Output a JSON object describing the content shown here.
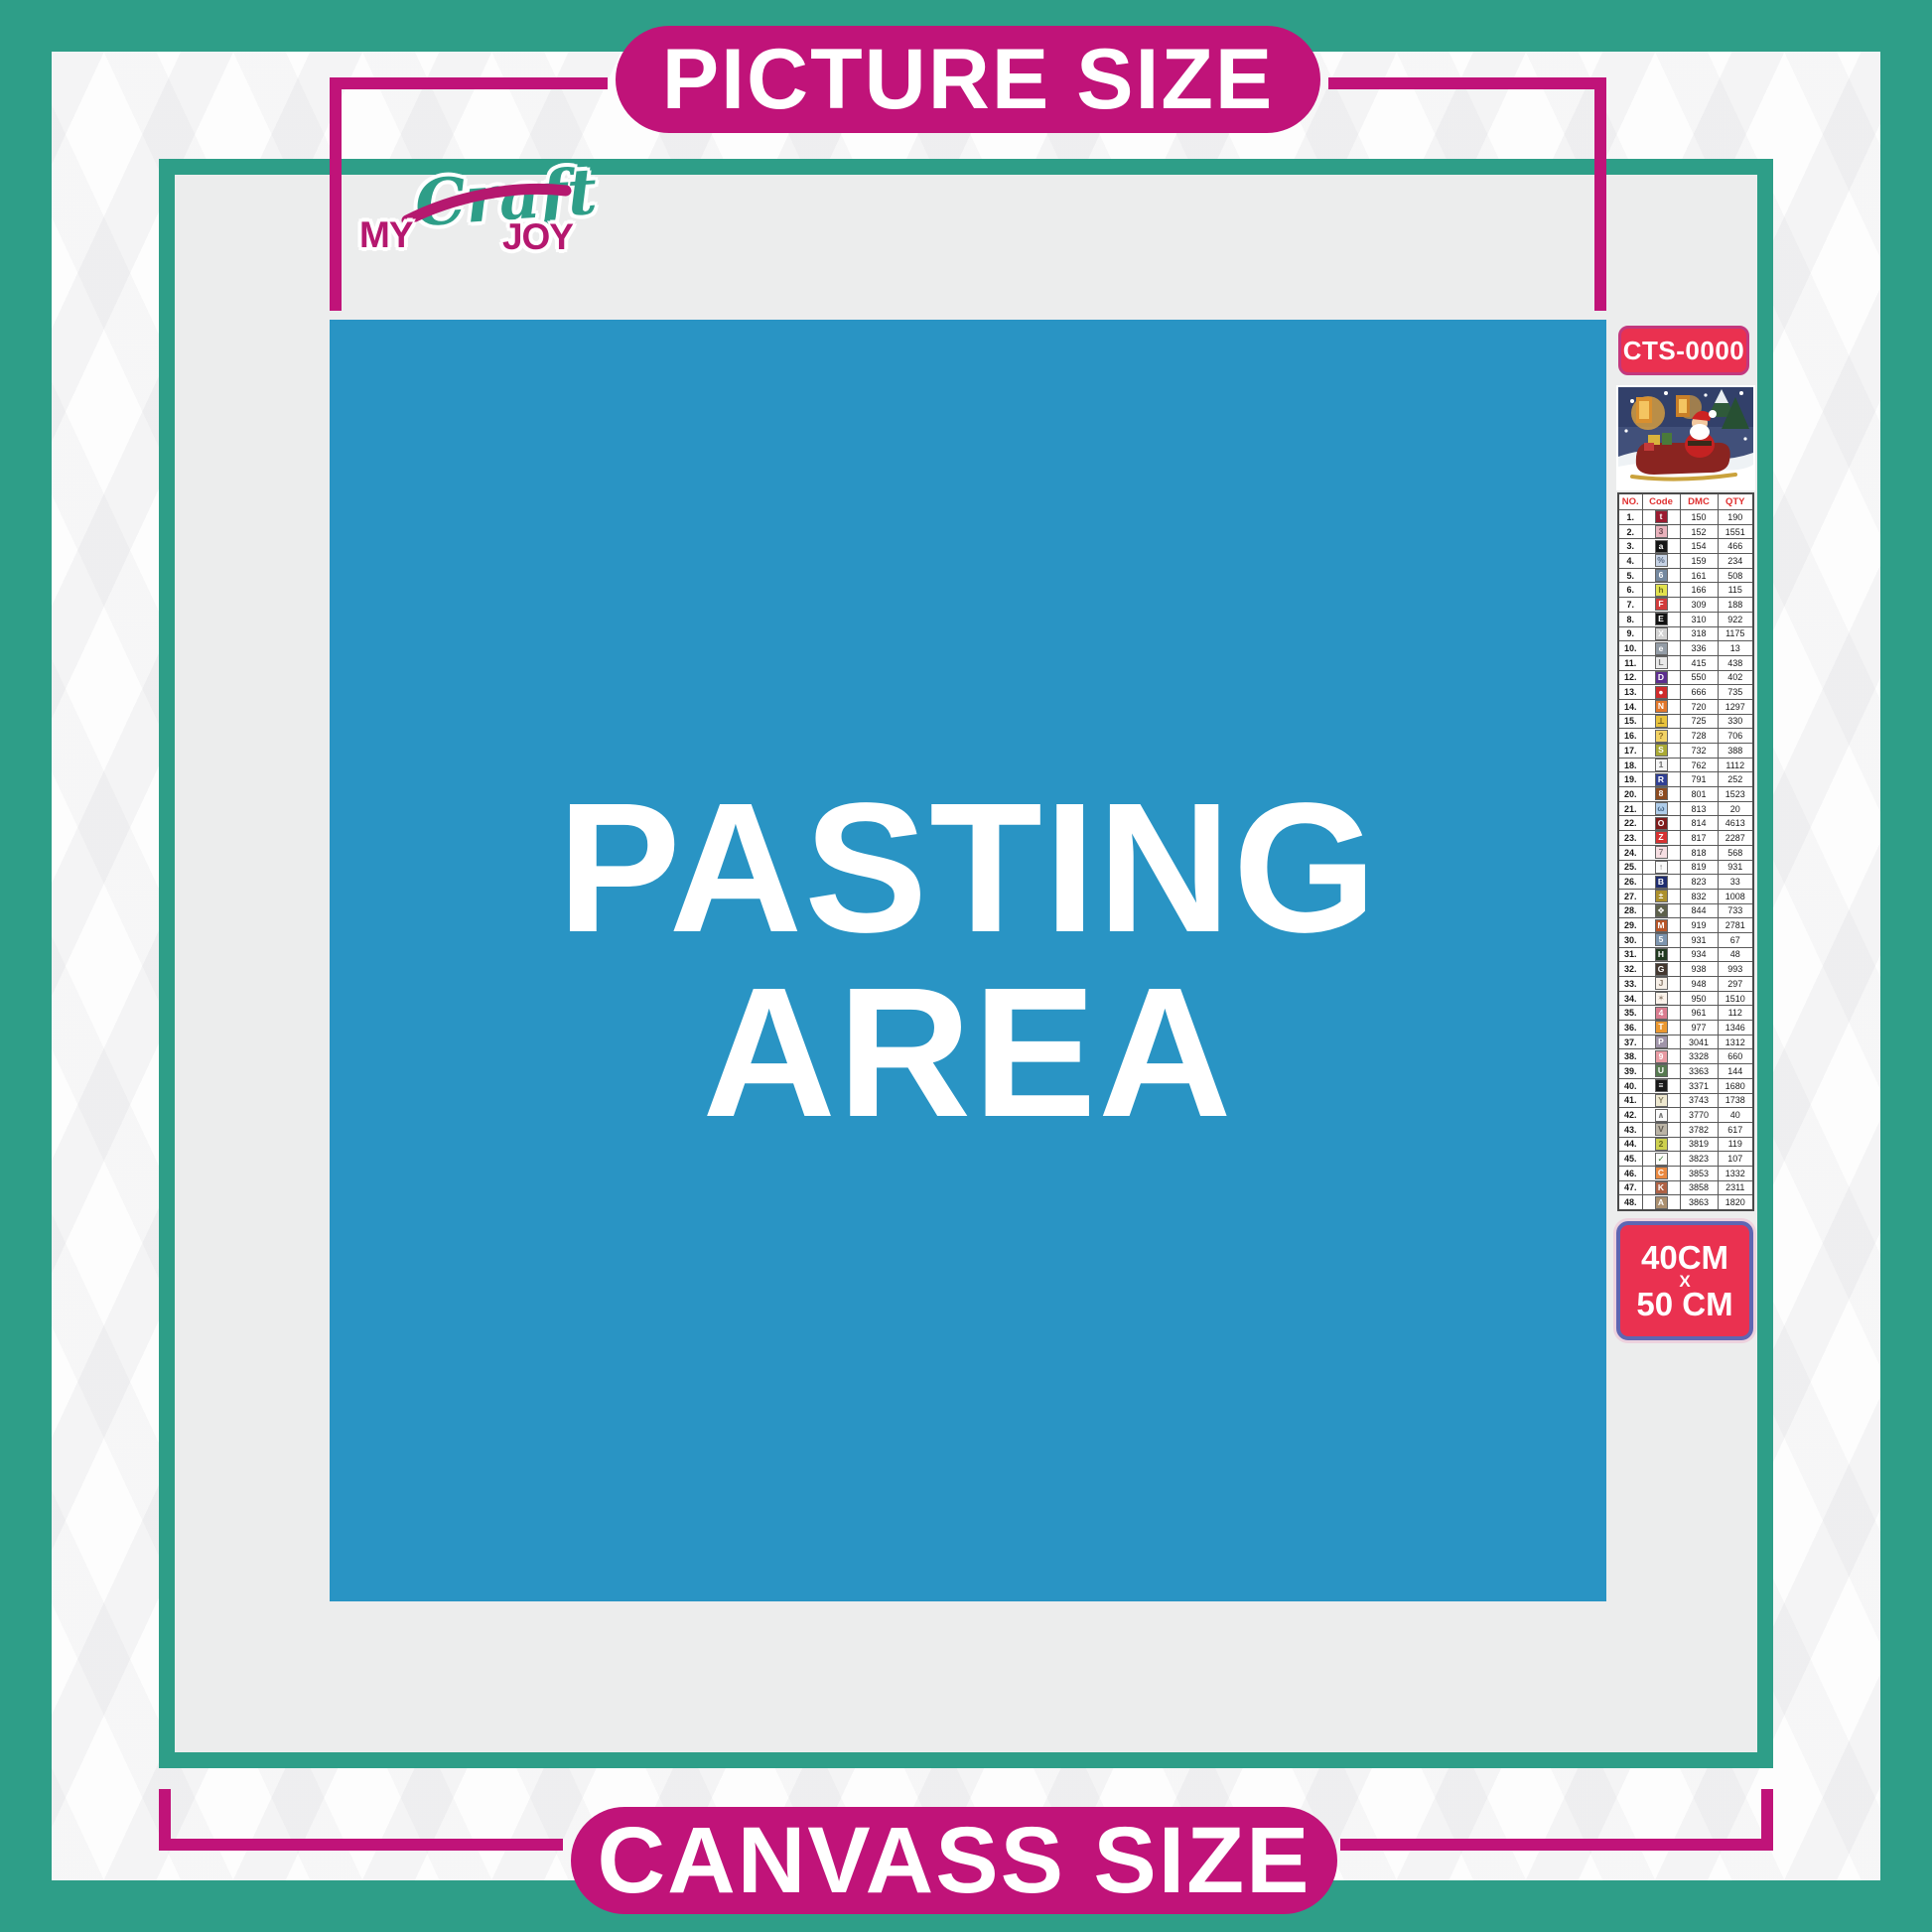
{
  "colors": {
    "teal": "#2E9E88",
    "magenta": "#C01379",
    "badge_red": "#EA3150",
    "pasting_blue": "#2994C4",
    "content_gray": "#ECEDED"
  },
  "banners": {
    "top": "PICTURE SIZE",
    "bottom": "CANVASS SIZE"
  },
  "logo": {
    "my": "MY",
    "craft": "Craft",
    "joy": "JOY"
  },
  "pasting": {
    "line1": "PASTING",
    "line2": "AREA"
  },
  "sidebar": {
    "sku": "CTS-0000",
    "preview": "santa-claus-sleigh-artwork",
    "size": {
      "l1": "40CM",
      "l2": "X",
      "l3": "50 CM"
    },
    "table": {
      "headers": [
        "NO.",
        "Code",
        "DMC",
        "QTY"
      ],
      "rows": [
        {
          "no": "1.",
          "sym": "t",
          "bg": "#9B1B30",
          "fg": "#FFFFFF",
          "dmc": "150",
          "qty": "190"
        },
        {
          "no": "2.",
          "sym": "3",
          "bg": "#E9B2BC",
          "fg": "#6E4A52",
          "dmc": "152",
          "qty": "1551"
        },
        {
          "no": "3.",
          "sym": "a",
          "bg": "#141414",
          "fg": "#FFFFFF",
          "dmc": "154",
          "qty": "466"
        },
        {
          "no": "4.",
          "sym": "%",
          "bg": "#C7D3E5",
          "fg": "#5A6B84",
          "dmc": "159",
          "qty": "234"
        },
        {
          "no": "5.",
          "sym": "6",
          "bg": "#74889F",
          "fg": "#FFFFFF",
          "dmc": "161",
          "qty": "508"
        },
        {
          "no": "6.",
          "sym": "h",
          "bg": "#E2E24E",
          "fg": "#6F6F1F",
          "dmc": "166",
          "qty": "115"
        },
        {
          "no": "7.",
          "sym": "F",
          "bg": "#D23B3B",
          "fg": "#FFFFFF",
          "dmc": "309",
          "qty": "188"
        },
        {
          "no": "8.",
          "sym": "E",
          "bg": "#121212",
          "fg": "#FFFFFF",
          "dmc": "310",
          "qty": "922"
        },
        {
          "no": "9.",
          "sym": "X",
          "bg": "#D2D2D2",
          "fg": "#FFFFFF",
          "dmc": "318",
          "qty": "1175"
        },
        {
          "no": "10.",
          "sym": "e",
          "bg": "#939CA6",
          "fg": "#FFFFFF",
          "dmc": "336",
          "qty": "13"
        },
        {
          "no": "11.",
          "sym": "L",
          "bg": "#E9E9E9",
          "fg": "#7A7A7A",
          "dmc": "415",
          "qty": "438"
        },
        {
          "no": "12.",
          "sym": "D",
          "bg": "#5C2D8E",
          "fg": "#FFFFFF",
          "dmc": "550",
          "qty": "402"
        },
        {
          "no": "13.",
          "sym": "●",
          "bg": "#D02B2B",
          "fg": "#FFFFFF",
          "dmc": "666",
          "qty": "735"
        },
        {
          "no": "14.",
          "sym": "N",
          "bg": "#E2762A",
          "fg": "#FFFFFF",
          "dmc": "720",
          "qty": "1297"
        },
        {
          "no": "15.",
          "sym": "⊥",
          "bg": "#E9C33C",
          "fg": "#6E5A1A",
          "dmc": "725",
          "qty": "330"
        },
        {
          "no": "16.",
          "sym": "?",
          "bg": "#F2D264",
          "fg": "#8A6A20",
          "dmc": "728",
          "qty": "706"
        },
        {
          "no": "17.",
          "sym": "S",
          "bg": "#A9A934",
          "fg": "#FFFFFF",
          "dmc": "732",
          "qty": "388"
        },
        {
          "no": "18.",
          "sym": "1",
          "bg": "#F5F5F5",
          "fg": "#6A6A6A",
          "dmc": "762",
          "qty": "1112"
        },
        {
          "no": "19.",
          "sym": "R",
          "bg": "#2F3F93",
          "fg": "#FFFFFF",
          "dmc": "791",
          "qty": "252"
        },
        {
          "no": "20.",
          "sym": "8",
          "bg": "#8C4B20",
          "fg": "#FFFFFF",
          "dmc": "801",
          "qty": "1523"
        },
        {
          "no": "21.",
          "sym": "ω",
          "bg": "#AFCDEA",
          "fg": "#4A6A8A",
          "dmc": "813",
          "qty": "20"
        },
        {
          "no": "22.",
          "sym": "O",
          "bg": "#7F1B1B",
          "fg": "#FFFFFF",
          "dmc": "814",
          "qty": "4613"
        },
        {
          "no": "23.",
          "sym": "Z",
          "bg": "#D63131",
          "fg": "#FFFFFF",
          "dmc": "817",
          "qty": "2287"
        },
        {
          "no": "24.",
          "sym": "7",
          "bg": "#F6DEE2",
          "fg": "#8A7A7E",
          "dmc": "818",
          "qty": "568"
        },
        {
          "no": "25.",
          "sym": "↑",
          "bg": "#FAFAFA",
          "fg": "#6A6A6A",
          "dmc": "819",
          "qty": "931"
        },
        {
          "no": "26.",
          "sym": "B",
          "bg": "#1E2C6F",
          "fg": "#FFFFFF",
          "dmc": "823",
          "qty": "33"
        },
        {
          "no": "27.",
          "sym": "±",
          "bg": "#AC902C",
          "fg": "#FFFFFF",
          "dmc": "832",
          "qty": "1008"
        },
        {
          "no": "28.",
          "sym": "❖",
          "bg": "#5D604A",
          "fg": "#FFFFFF",
          "dmc": "844",
          "qty": "733"
        },
        {
          "no": "29.",
          "sym": "M",
          "bg": "#B75528",
          "fg": "#FFFFFF",
          "dmc": "919",
          "qty": "2781"
        },
        {
          "no": "30.",
          "sym": "5",
          "bg": "#7C94AE",
          "fg": "#FFFFFF",
          "dmc": "931",
          "qty": "67"
        },
        {
          "no": "31.",
          "sym": "H",
          "bg": "#213A20",
          "fg": "#FFFFFF",
          "dmc": "934",
          "qty": "48"
        },
        {
          "no": "32.",
          "sym": "G",
          "bg": "#43372F",
          "fg": "#FFFFFF",
          "dmc": "938",
          "qty": "993"
        },
        {
          "no": "33.",
          "sym": "J",
          "bg": "#F6EFE7",
          "fg": "#8A7A6A",
          "dmc": "948",
          "qty": "297"
        },
        {
          "no": "34.",
          "sym": "✶",
          "bg": "#FBF3EB",
          "fg": "#9A8A7A",
          "dmc": "950",
          "qty": "1510"
        },
        {
          "no": "35.",
          "sym": "4",
          "bg": "#DA7C8F",
          "fg": "#FFFFFF",
          "dmc": "961",
          "qty": "112"
        },
        {
          "no": "36.",
          "sym": "T",
          "bg": "#EA972F",
          "fg": "#FFFFFF",
          "dmc": "977",
          "qty": "1346"
        },
        {
          "no": "37.",
          "sym": "P",
          "bg": "#A094A9",
          "fg": "#FFFFFF",
          "dmc": "3041",
          "qty": "1312"
        },
        {
          "no": "38.",
          "sym": "9",
          "bg": "#E89BA3",
          "fg": "#FFFFFF",
          "dmc": "3328",
          "qty": "660"
        },
        {
          "no": "39.",
          "sym": "U",
          "bg": "#567A50",
          "fg": "#FFFFFF",
          "dmc": "3363",
          "qty": "144"
        },
        {
          "no": "40.",
          "sym": "≡",
          "bg": "#181818",
          "fg": "#FFFFFF",
          "dmc": "3371",
          "qty": "1680"
        },
        {
          "no": "41.",
          "sym": "Y",
          "bg": "#EFE9D0",
          "fg": "#8A8468",
          "dmc": "3743",
          "qty": "1738"
        },
        {
          "no": "42.",
          "sym": "∧",
          "bg": "#FBFBFB",
          "fg": "#777777",
          "dmc": "3770",
          "qty": "40"
        },
        {
          "no": "43.",
          "sym": "V",
          "bg": "#BAB3A5",
          "fg": "#5F5950",
          "dmc": "3782",
          "qty": "617"
        },
        {
          "no": "44.",
          "sym": "2",
          "bg": "#CED14F",
          "fg": "#6A6D20",
          "dmc": "3819",
          "qty": "119"
        },
        {
          "no": "45.",
          "sym": "✓",
          "bg": "#FDFDF9",
          "fg": "#3F7F3F",
          "dmc": "3823",
          "qty": "107"
        },
        {
          "no": "46.",
          "sym": "C",
          "bg": "#EA8940",
          "fg": "#FFFFFF",
          "dmc": "3853",
          "qty": "1332"
        },
        {
          "no": "47.",
          "sym": "K",
          "bg": "#AE6144",
          "fg": "#FFFFFF",
          "dmc": "3858",
          "qty": "2311"
        },
        {
          "no": "48.",
          "sym": "A",
          "bg": "#AA8F6E",
          "fg": "#FFFFFF",
          "dmc": "3863",
          "qty": "1820"
        }
      ]
    }
  }
}
